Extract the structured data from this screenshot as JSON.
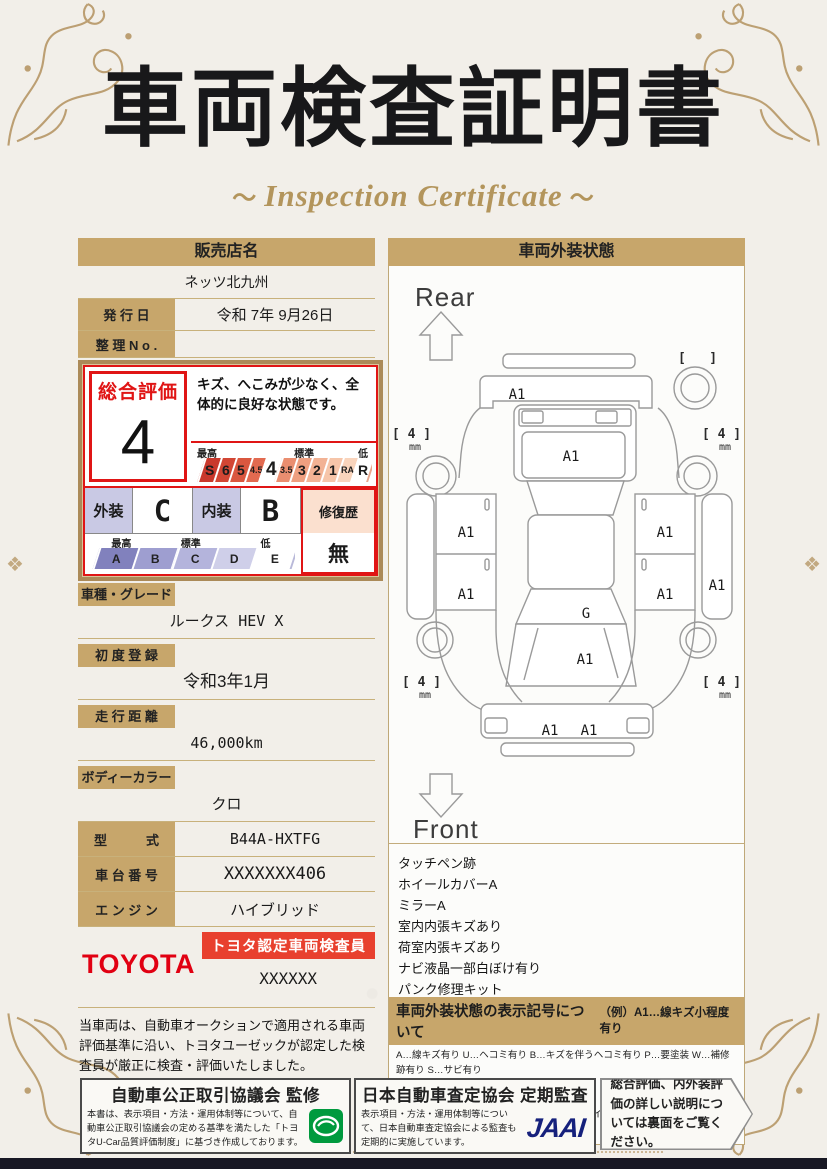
{
  "colors": {
    "accent_red": "#e01515",
    "toyota_red": "#e10012",
    "tan": "#c7a66b",
    "gold_ornament": "#b3925f",
    "jaai_navy": "#16217c",
    "seal_green": "#009a3e"
  },
  "page": {
    "title": "車両検査証明書",
    "subtitle": "Inspection Certificate"
  },
  "dealer": {
    "header": "販売店名",
    "name": "ネッツ北九州",
    "issue_label": "発 行 日",
    "issue_value": "令和 7年 9月26日",
    "ref_label": "整 理 N o .",
    "ref_value": ""
  },
  "rating": {
    "overall_label": "総合評価",
    "overall_value": "4",
    "comment": "キズ、へこみが少なく、全体的に良好な状態です。",
    "scale_high": "最高",
    "scale_mid": "標準",
    "scale_low": "低",
    "overall_scale": [
      "S",
      "6",
      "5",
      "4.5",
      "4",
      "3.5",
      "3",
      "2",
      "1",
      "RA",
      "R"
    ],
    "exterior_label": "外装",
    "exterior_value": "C",
    "interior_label": "内装",
    "interior_value": "B",
    "grade_scale": [
      "A",
      "B",
      "C",
      "D",
      "E"
    ],
    "repair_label": "修復歴",
    "repair_value": "無"
  },
  "details": {
    "rows": [
      {
        "label": "車種・グレード",
        "value": "ルークス HEV X"
      },
      {
        "label": "初 度 登 録",
        "value": "令和3年1月"
      },
      {
        "label": "走 行 距 離",
        "value": "46,000km"
      },
      {
        "label": "ボディーカラー",
        "value": "クロ"
      },
      {
        "label": "型　　　式",
        "value": "B44A-HXTFG"
      },
      {
        "label": "車 台 番 号",
        "value": "XXXXXXX406"
      },
      {
        "label": "エ ン ジ ン",
        "value": "ハイブリッド"
      }
    ]
  },
  "inspector": {
    "brand": "TOYOTA",
    "badge": "トヨタ認定車両検査員",
    "name": "XXXXXX",
    "statement": "当車両は、自動車オークションで適用される車両評価基準に沿い、トヨタユーゼックが認定した検査員が厳正に検査・評価いたしました。"
  },
  "exterior_map": {
    "header": "車両外装状態",
    "rear_label": "Rear",
    "front_label": "Front",
    "marks": {
      "rear_bumper": "A1",
      "rear_gate": "A1",
      "left_rear_door": "A1",
      "left_front_door": "A1",
      "right_rear_door": "A1",
      "right_front_door": "A1",
      "right_side": "A1",
      "windshield": "G",
      "hood": "A1",
      "front_bumper_left": "A1",
      "front_bumper_right": "A1"
    },
    "tire_unit": "mm",
    "tires": {
      "rear_left": "4",
      "rear_right": "4",
      "front_left": "4",
      "front_right": "4"
    },
    "notes": [
      "タッチペン跡",
      "ホイールカバーA",
      "ミラーA",
      "室内内張キズあり",
      "荷室内張キズあり",
      "ナビ液晶一部白ぼけ有り",
      "パンク修理キット"
    ],
    "legend": {
      "title": "車両外装状態の表示記号について",
      "example": "（例）A1…線キズ小程度有り",
      "lines": [
        "A…線キズ有り U…ヘコミ有り B…キズを伴うヘコミ有り P…要塗装 W…補修跡有り S…サビ有り",
        "C…腐食有り　G…フロントガラス点キズ有り　X…要交換（裏面に補足あり）　XX…交換歴有り",
        "1…小程度　2…中程度　3…中程度以上　※タイヤ横の数字は、残り溝を示しています。"
      ]
    }
  },
  "footer": {
    "fair_trade_title": "自動車公正取引協議会 監修",
    "fair_trade_body": "本書は、表示項目・方法・運用体制等について、自動車公正取引協議会の定める基準を満たした「トヨタU-Car品質評価制度」に基づき作成しております。",
    "jaai_title": "日本自動車査定協会 定期監査",
    "jaai_body": "表示項目・方法・運用体制等について、日本自動車査定協会による監査も定期的に実施しています。",
    "jaai_logo": "JAAI",
    "back_note": "総合評価、内外装評価の詳しい説明については裏面をご覧ください。"
  }
}
